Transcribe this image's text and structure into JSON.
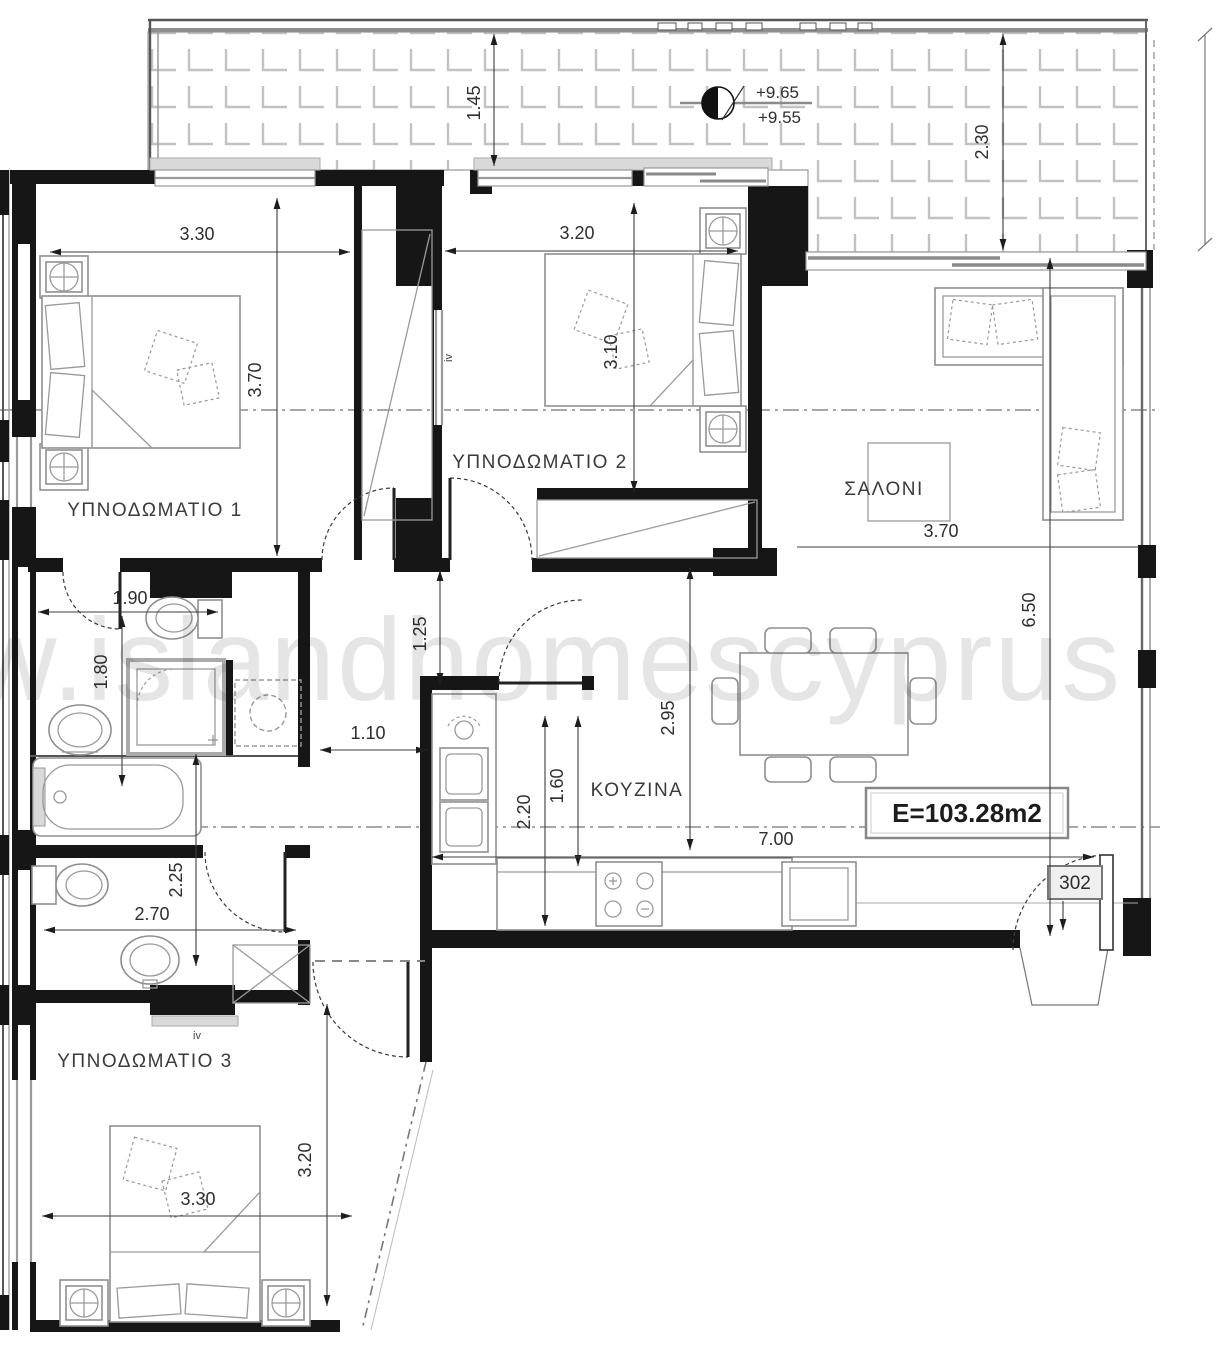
{
  "plan": {
    "watermark": "w.islandhomescyprus",
    "area_label": "E=103.28m2",
    "apartment_number": "302",
    "window_tag": "iv",
    "levels": {
      "upper": "+9.65",
      "lower": "+9.55"
    },
    "rooms": {
      "bedroom1": "ΥΠΝΟΔΩΜΑΤΙΟ 1",
      "bedroom2": "ΥΠΝΟΔΩΜΑΤΙΟ 2",
      "bedroom3": "ΥΠΝΟΔΩΜΑΤΙΟ 3",
      "living_room": "ΣΑΛΟΝΙ",
      "kitchen": "ΚΟΥΖΙΝΑ"
    },
    "dimensions": {
      "balcony_depth_left": "1.45",
      "balcony_depth_right": "2.30",
      "bedroom1_width": "3.30",
      "bedroom1_depth": "3.70",
      "bedroom2_width": "3.20",
      "bedroom2_depth": "3.10",
      "living_width": "3.70",
      "living_depth": "6.50",
      "kitchen_depth_a": "2.95",
      "kitchen_depth_b": "1.60",
      "kitchen_depth_c": "2.20",
      "open_plan_width": "7.00",
      "hall_width": "1.10",
      "kitchen_door": "1.25",
      "bath_width": "1.90",
      "bath_depth": "1.80",
      "wc_depth": "2.25",
      "wc_width": "2.70",
      "bedroom3_width": "3.30",
      "bedroom3_depth": "3.20"
    }
  }
}
